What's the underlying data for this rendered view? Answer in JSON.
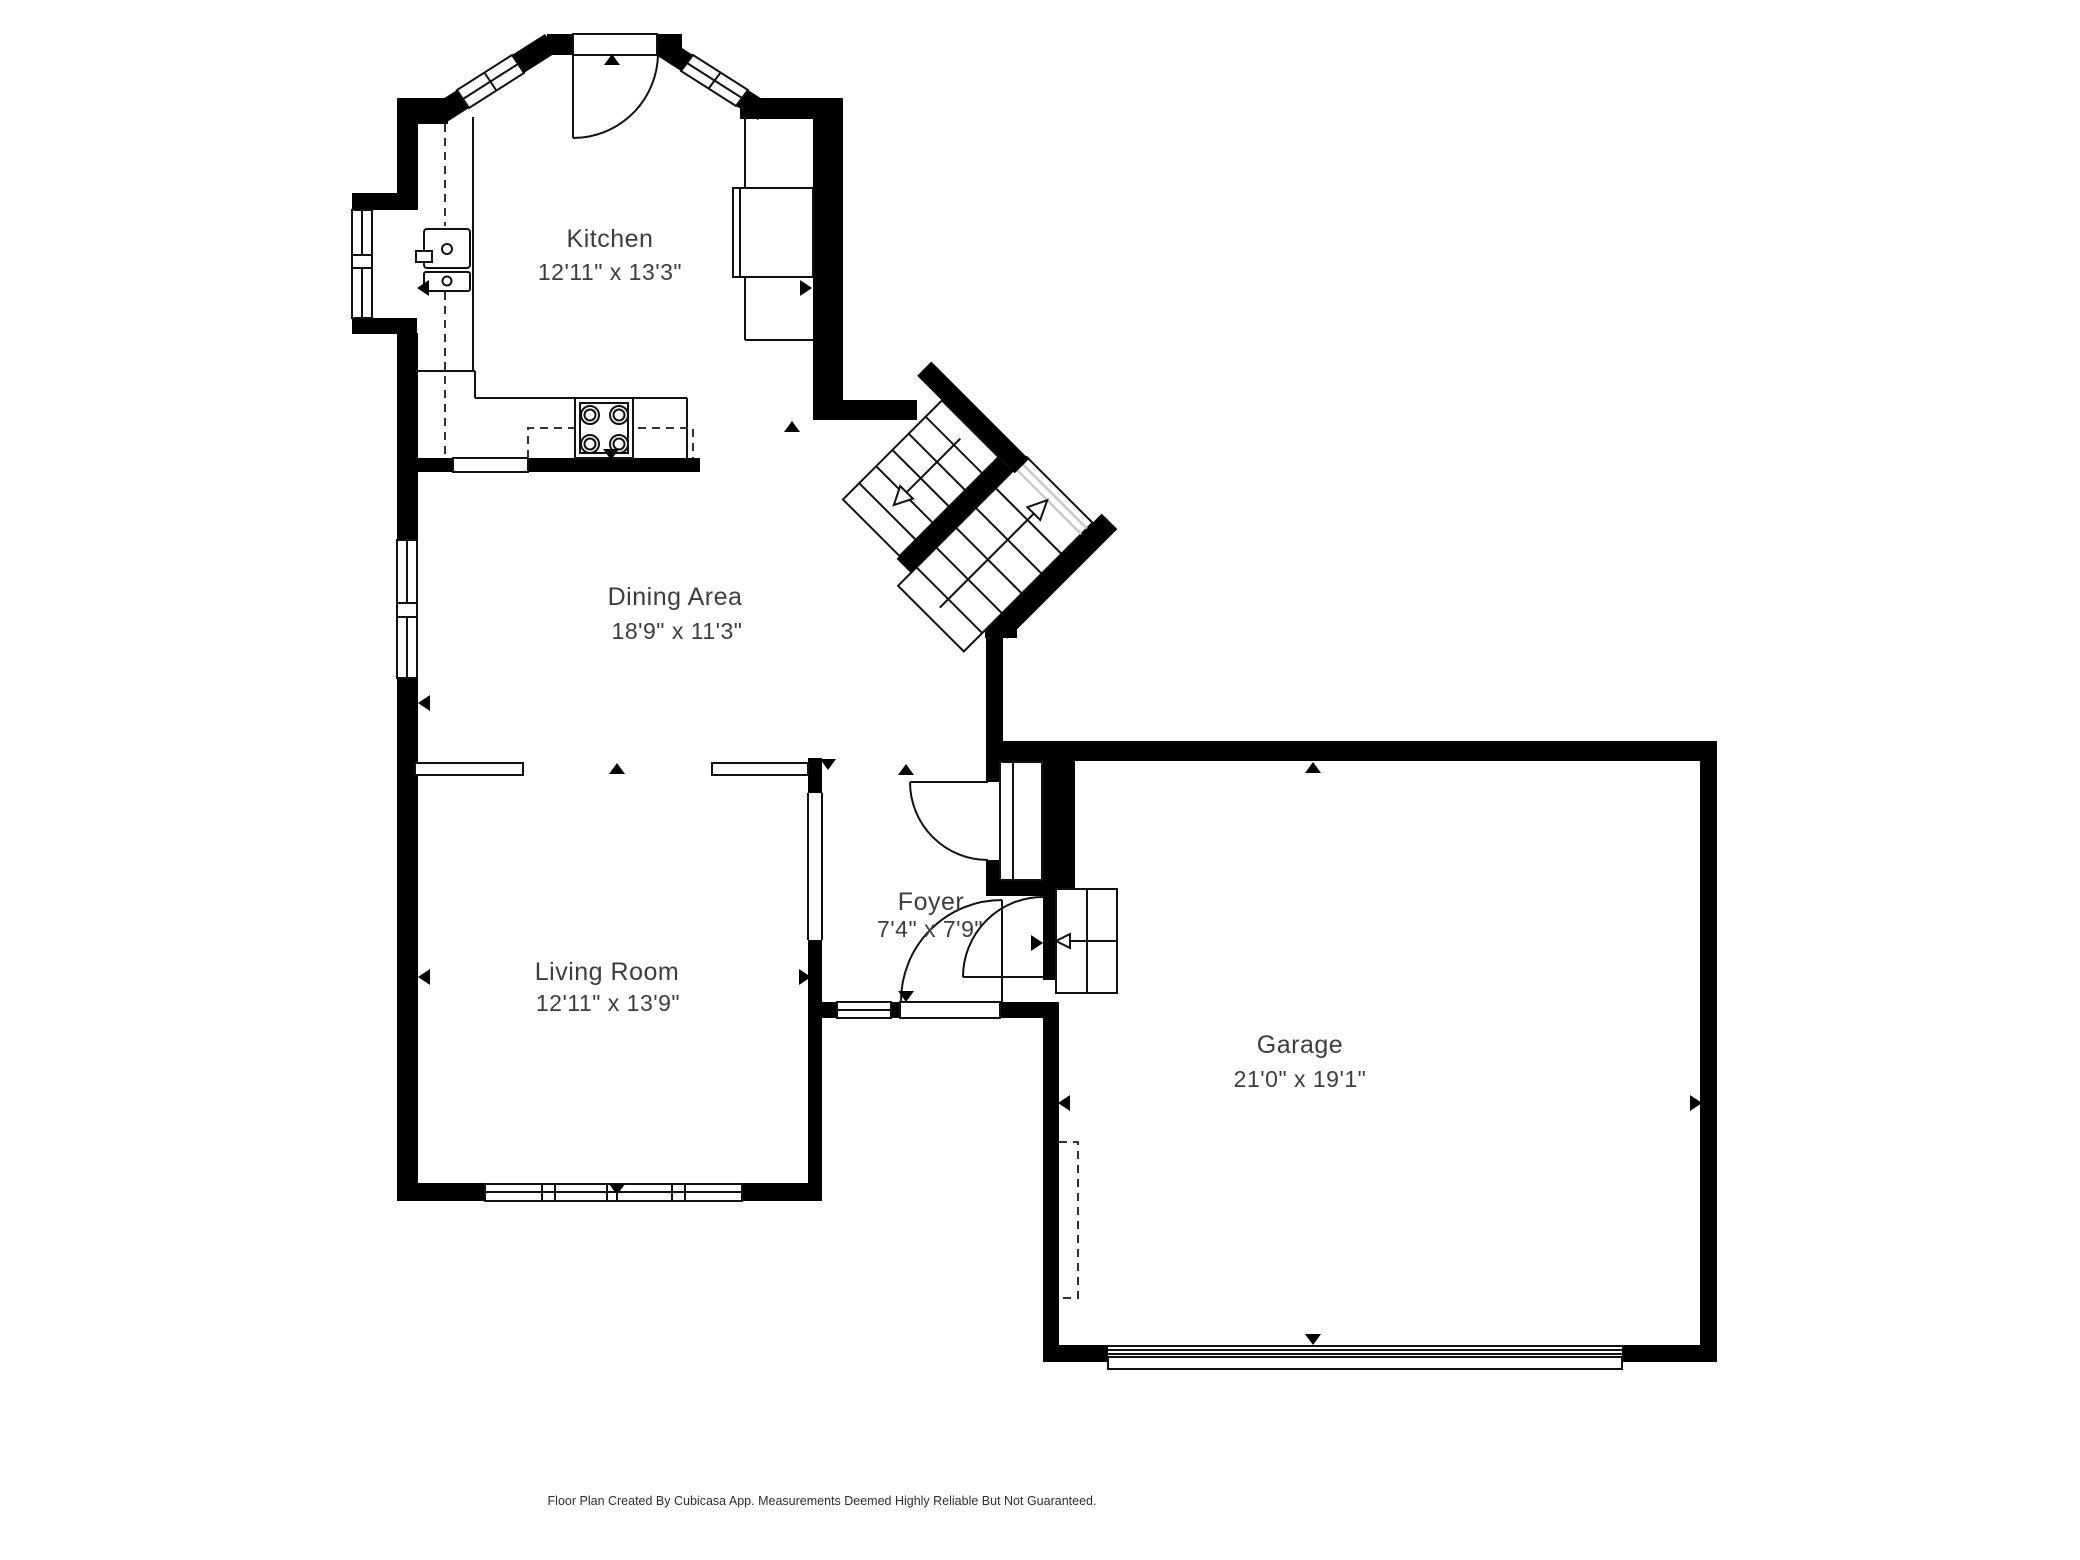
{
  "rooms": {
    "kitchen": {
      "name": "Kitchen",
      "dims": "12'11\" x 13'3\""
    },
    "dining": {
      "name": "Dining Area",
      "dims": "18'9\" x 11'3\""
    },
    "living": {
      "name": "Living Room",
      "dims": "12'11\" x 13'9\""
    },
    "foyer": {
      "name": "Foyer",
      "dims": "7'4\" x 7'9\""
    },
    "garage": {
      "name": "Garage",
      "dims": "21'0\" x 19'1\""
    }
  },
  "footer": {
    "text": "Floor Plan Created By Cubicasa App. Measurements Deemed Highly Reliable But Not Guaranteed."
  },
  "colors": {
    "wall": "#000000",
    "label": "#3d3d3d",
    "footer_text": "#2e2e2e",
    "stair_landing_line": "#c9c9c9",
    "background": "#ffffff"
  },
  "symbols": {
    "measure_arrow": "small filled black triangle",
    "stair_direction_arrow": "open outlined arrow",
    "door_swing": "quarter-circle arc with leaf line",
    "window": "white band with mullion lines",
    "stove_icon": "square with 4 burner circles",
    "sink_icon": "double-bowl with drains",
    "garage_door": "wide slatted band"
  }
}
